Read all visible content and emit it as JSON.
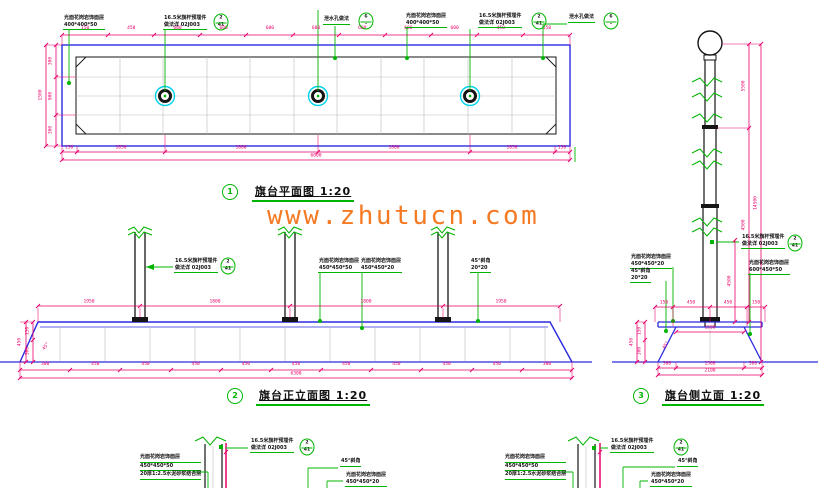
{
  "watermark": "www.zhutucn.com",
  "plan": {
    "num": "1",
    "title": "旗台平面图",
    "scale": "1:20",
    "callouts": [
      {
        "l1": "光面花岗岩饰面层",
        "l2": "400*400*50"
      },
      {
        "l1": "16.5米旗杆预埋件",
        "l2": "做法详 02J003",
        "rt": "2",
        "rb": "41"
      },
      {
        "l1": "泄水孔做法",
        "rt": "6",
        "rb": "–"
      },
      {
        "l1": "光面花岗岩饰面层",
        "l2": "400*400*50"
      },
      {
        "l1": "16.5米旗杆预埋件",
        "l2": "做法详 02J003",
        "rt": "2",
        "rb": "41"
      },
      {
        "l1": "泄水孔做法",
        "rt": "6",
        "rb": "–"
      }
    ],
    "dims_top": [
      "150",
      "450",
      "600",
      "600",
      "600",
      "600",
      "600",
      "600",
      "600",
      "450",
      "150"
    ],
    "left_total": "1500",
    "left_segs": [
      "300",
      "900",
      "300"
    ],
    "dims_bottom": [
      "150",
      "1050",
      "1800",
      "1800",
      "1050",
      "150"
    ],
    "total": "6000"
  },
  "front": {
    "num": "2",
    "title": "旗台正立面图",
    "scale": "1:20",
    "embed": {
      "l1": "16.5米旗杆预埋件",
      "l2": "做法详 02J003",
      "rt": "2",
      "rb": "41"
    },
    "callouts": [
      {
        "l1": "光面花岗岩饰面层",
        "l2": "450*450*50"
      },
      {
        "l1": "光面花岗岩饰面层",
        "l2": "450*450*20"
      },
      {
        "l1": "45°斜角",
        "l2": "20*20"
      }
    ],
    "dims_above": [
      "1950",
      "1800",
      "1800",
      "1950"
    ],
    "left_segs": [
      "150",
      "300"
    ],
    "left_total": "450",
    "angle": "45°",
    "dims_bottom": [
      "300",
      "450",
      "450",
      "450",
      "450",
      "450",
      "450",
      "450",
      "450",
      "450",
      "300"
    ],
    "total": "6300"
  },
  "side": {
    "num": "3",
    "title": "旗台侧立面",
    "scale": "1:20",
    "embed": {
      "l1": "16.5米旗杆预埋件",
      "l2": "做法详 02J003",
      "rt": "2",
      "rb": "41"
    },
    "right_face": {
      "l1": "光面花岗岩饰面层",
      "l2": "600*450*50"
    },
    "left_face": {
      "l1": "光面花岗岩饰面层",
      "l2": "450*450*20"
    },
    "left_bevel": {
      "l1": "45°斜角",
      "l2": "20*20"
    },
    "pole_segs": [
      "5500",
      "4500"
    ],
    "base_height": "4500",
    "total_height": "14500",
    "top_row": [
      "150",
      "450",
      "450",
      "150"
    ],
    "mid": "1500",
    "left_segs": [
      "150",
      "300"
    ],
    "left_total": "450",
    "angle": "45°",
    "dims_bottom": [
      "300",
      "1500",
      "300"
    ],
    "total": "2100"
  },
  "detail": {
    "embed": {
      "l1": "16.5米旗杆预埋件",
      "l2": "做法详 02J003",
      "rt": "2",
      "rb": "41"
    },
    "bevel": "45°斜角",
    "face": {
      "l1": "光面花岗岩饰面层",
      "l2": "450*450*20"
    },
    "note": [
      "光面花岗岩饰面层",
      "450*450*50",
      "20厚1:2.5水泥砂浆结合层"
    ]
  }
}
